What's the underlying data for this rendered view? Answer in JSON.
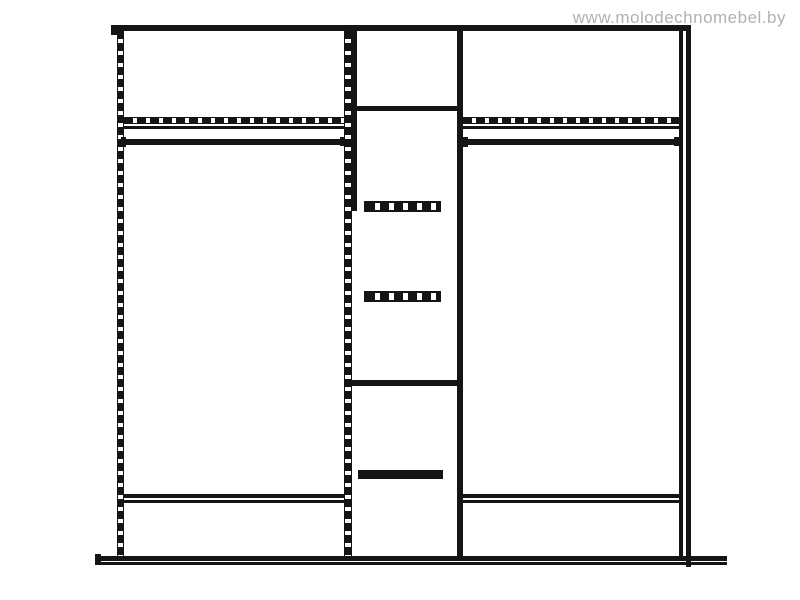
{
  "watermark": {
    "text": "www.molodechnomebel.by",
    "color": "#b1b1b1"
  },
  "canvas": {
    "width": 800,
    "height": 600,
    "background": "#ffffff",
    "line_color": "#151515"
  },
  "drawing": {
    "description": "Front-view technical line drawing of a three-section wardrobe: two wide hanging sections (top shelf shown dashed, hanging rail, bottom shelf) flanking a narrow center column with a top shelf, two dashed drawer fronts, a middle shelf and one solid drawer handle, all on a plinth base",
    "elements": [
      {
        "name": "top-edge-line",
        "type": "solid",
        "x": 111,
        "y": 25,
        "w": 576,
        "h": 6
      },
      {
        "name": "top-edge-left-cap",
        "type": "solid",
        "x": 111,
        "y": 31,
        "w": 6,
        "h": 4
      },
      {
        "name": "right-side-panel-outer-line",
        "type": "solid",
        "x": 686,
        "y": 25,
        "w": 5,
        "h": 542
      },
      {
        "name": "right-side-panel-inner-line",
        "type": "solid",
        "x": 679,
        "y": 31,
        "w": 4,
        "h": 526
      },
      {
        "name": "left-side-panel-dashed-line",
        "type": "dash-v",
        "x": 117,
        "y": 31,
        "w": 7,
        "h": 526
      },
      {
        "name": "center-divider-dashed-line",
        "type": "dash-v",
        "x": 344,
        "y": 31,
        "w": 8,
        "h": 526
      },
      {
        "name": "mid-column-left-panel-line",
        "type": "solid",
        "x": 352,
        "y": 31,
        "w": 5,
        "h": 180
      },
      {
        "name": "mid-column-right-panel-line",
        "type": "solid",
        "x": 457,
        "y": 31,
        "w": 6,
        "h": 530
      },
      {
        "name": "mid-column-top-shelf-line",
        "type": "solid",
        "x": 352,
        "y": 106,
        "w": 111,
        "h": 5
      },
      {
        "name": "left-shelf-hidden-edge-dashed",
        "type": "dash-h",
        "x": 124,
        "y": 117,
        "w": 220,
        "h": 7
      },
      {
        "name": "right-shelf-hidden-edge-dashed",
        "type": "dash-h",
        "x": 463,
        "y": 117,
        "w": 216,
        "h": 7
      },
      {
        "name": "left-shelf-front-edge-line",
        "type": "solid",
        "x": 124,
        "y": 126,
        "w": 220,
        "h": 3
      },
      {
        "name": "right-shelf-front-edge-line",
        "type": "solid",
        "x": 463,
        "y": 126,
        "w": 216,
        "h": 3
      },
      {
        "name": "left-hanging-rail",
        "type": "solid",
        "x": 121,
        "y": 139,
        "w": 224,
        "h": 6
      },
      {
        "name": "left-rail-left-cap",
        "type": "solid",
        "x": 121,
        "y": 137,
        "w": 5,
        "h": 10
      },
      {
        "name": "left-rail-right-cap",
        "type": "solid",
        "x": 340,
        "y": 137,
        "w": 5,
        "h": 9
      },
      {
        "name": "right-hanging-rail",
        "type": "solid",
        "x": 463,
        "y": 139,
        "w": 215,
        "h": 6
      },
      {
        "name": "right-rail-left-cap",
        "type": "solid",
        "x": 463,
        "y": 137,
        "w": 5,
        "h": 10
      },
      {
        "name": "right-rail-right-cap",
        "type": "solid",
        "x": 674,
        "y": 137,
        "w": 5,
        "h": 9
      },
      {
        "name": "mid-drawer-dashed-handle-1",
        "type": "dash-bar",
        "x": 364,
        "y": 201,
        "w": 77,
        "h": 11
      },
      {
        "name": "mid-drawer-dashed-handle-2",
        "type": "dash-bar",
        "x": 364,
        "y": 291,
        "w": 77,
        "h": 11
      },
      {
        "name": "mid-column-middle-shelf-line",
        "type": "solid",
        "x": 352,
        "y": 380,
        "w": 105,
        "h": 6
      },
      {
        "name": "mid-drawer-solid-handle",
        "type": "solid",
        "x": 358,
        "y": 470,
        "w": 85,
        "h": 9
      },
      {
        "name": "left-bottom-shelf-top-line",
        "type": "solid",
        "x": 124,
        "y": 494,
        "w": 221,
        "h": 4
      },
      {
        "name": "left-bottom-shelf-bottom-line",
        "type": "solid",
        "x": 124,
        "y": 500,
        "w": 221,
        "h": 3
      },
      {
        "name": "right-bottom-shelf-top-line",
        "type": "solid",
        "x": 463,
        "y": 494,
        "w": 216,
        "h": 4
      },
      {
        "name": "right-bottom-shelf-bottom-line",
        "type": "solid",
        "x": 463,
        "y": 500,
        "w": 216,
        "h": 3
      },
      {
        "name": "base-left-cap",
        "type": "solid",
        "x": 95,
        "y": 554,
        "w": 6,
        "h": 11
      },
      {
        "name": "base-top-line",
        "type": "solid",
        "x": 96,
        "y": 556,
        "w": 631,
        "h": 5
      },
      {
        "name": "base-bottom-line",
        "type": "solid",
        "x": 96,
        "y": 562,
        "w": 631,
        "h": 3
      }
    ]
  }
}
